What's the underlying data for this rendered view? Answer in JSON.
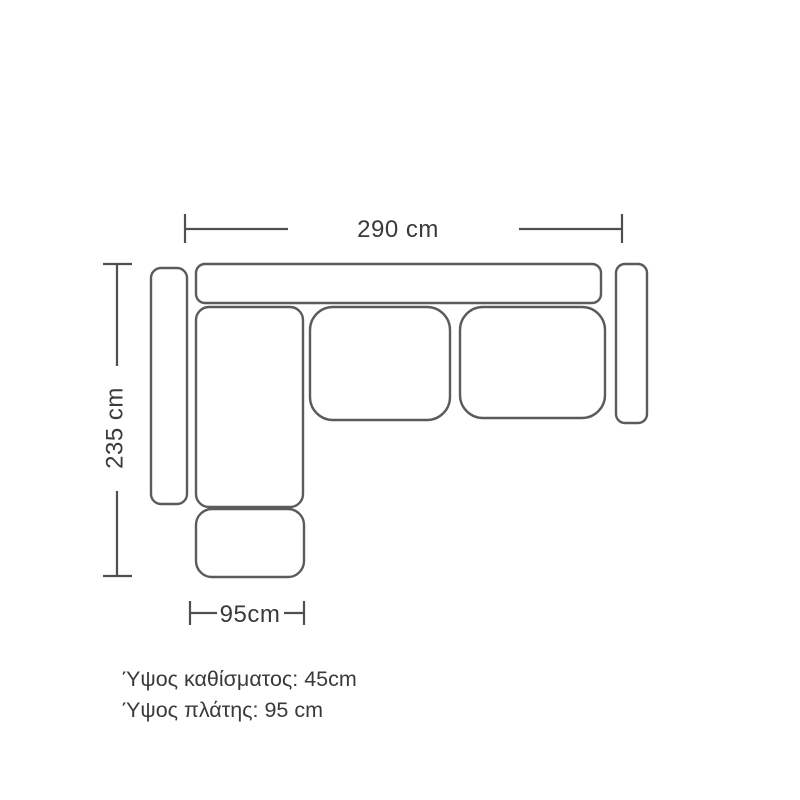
{
  "page": {
    "background": "#ffffff"
  },
  "diagram": {
    "kind": "corner-sofa-top-view-dimension-drawing",
    "stroke_color": "#5b5b5b",
    "dim_line_color": "#4f4f4f",
    "text_color": "#3a3a3a",
    "dimensions": {
      "width_label": "290 cm",
      "depth_label": "235 cm",
      "chaise_width_label": "95cm"
    },
    "notes": {
      "seat_height": "Ύψος καθίσματος: 45cm",
      "back_height": "Ύψος πλάτης: 95 cm"
    },
    "parts": [
      {
        "name": "back-cushion",
        "x": 196,
        "y": 264,
        "w": 405,
        "h": 39,
        "r": 9
      },
      {
        "name": "left-armrest",
        "x": 151,
        "y": 268,
        "w": 36,
        "h": 236,
        "r": 10
      },
      {
        "name": "right-armrest",
        "x": 616,
        "y": 264,
        "w": 31,
        "h": 159,
        "r": 9
      },
      {
        "name": "chaise-seat",
        "x": 196,
        "y": 307,
        "w": 107,
        "h": 200,
        "r": 13
      },
      {
        "name": "middle-seat-cushion",
        "x": 310,
        "y": 307,
        "w": 140,
        "h": 113,
        "r": 23
      },
      {
        "name": "right-seat-cushion",
        "x": 460,
        "y": 307,
        "w": 145,
        "h": 111,
        "r": 23
      },
      {
        "name": "ottoman",
        "x": 196,
        "y": 509,
        "w": 108,
        "h": 68,
        "r": 16
      }
    ]
  }
}
